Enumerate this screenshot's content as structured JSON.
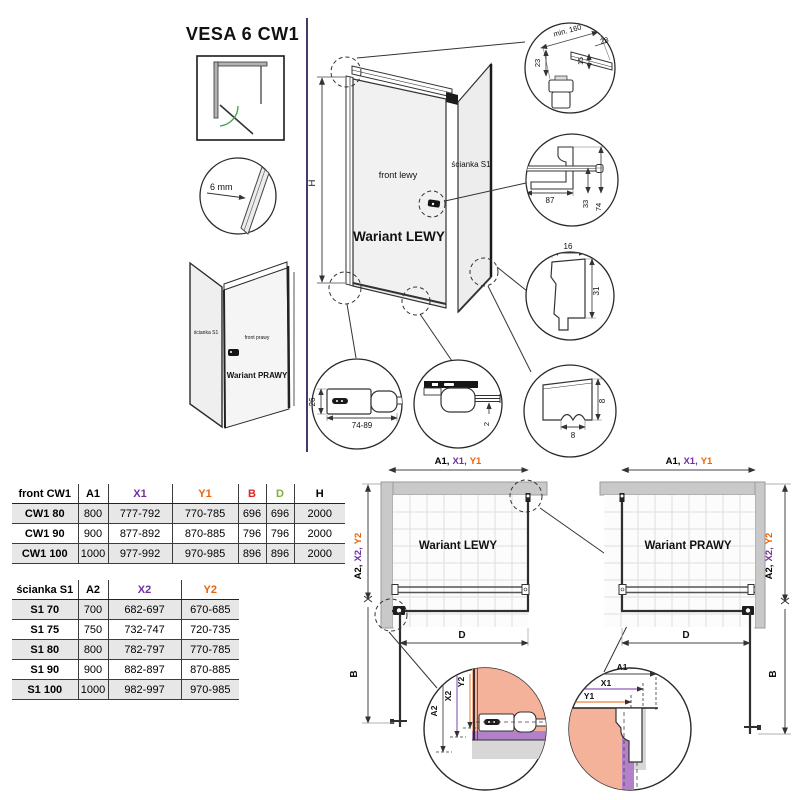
{
  "title": "VESA 6 CW1",
  "colors": {
    "purple": "#7030a0",
    "orange": "#e8650a",
    "red": "#e02424",
    "green": "#7fae3a",
    "salmon": "#f5b29b",
    "violet": "#b381c9",
    "wall_gray": "#c9c9c9",
    "line": "#333333"
  },
  "left_icons": {
    "glass_thickness": "6 mm"
  },
  "small_view": {
    "side_label": "ścianka S1",
    "front_label": "front prawy",
    "variant": "Wariant PRAWY"
  },
  "main_view": {
    "side_label": "ścianka S1",
    "front_label": "front lewy",
    "variant": "Wariant LEWY",
    "height": "H"
  },
  "details": {
    "corner": {
      "min_offset": "min. 160",
      "width": "28",
      "depth": "15",
      "height": "23"
    },
    "bracket": {
      "length": "87",
      "offset": "33",
      "total": "74"
    },
    "profile": {
      "width": "16",
      "depth": "31"
    },
    "handle": {
      "height": "26",
      "range": "74-89"
    },
    "door_bottom": {
      "gap": "2"
    },
    "seal": {
      "height": "8",
      "width": "8"
    }
  },
  "plans": {
    "left_variant": "Wariant LEWY",
    "right_variant": "Wariant PRAWY",
    "top_dim": {
      "a1": "A1,",
      "x1": "X1,",
      "y1": "Y1"
    },
    "side_dim": {
      "a2": "A2,",
      "x2": "X2,",
      "y2": "Y2"
    },
    "width_dim": "D",
    "door_dim": "B"
  },
  "zoom_details": {
    "left": {
      "a2": "A2",
      "x2": "X2",
      "y2": "Y2"
    },
    "right": {
      "a1": "A1",
      "x1": "X1",
      "y1": "Y1"
    }
  },
  "tables": {
    "front": {
      "header": [
        {
          "label": "front CW1",
          "color": "#000000"
        },
        {
          "label": "A1",
          "color": "#000000"
        },
        {
          "label": "X1",
          "color": "#7030a0"
        },
        {
          "label": "Y1",
          "color": "#e8650a"
        },
        {
          "label": "B",
          "color": "#e02424"
        },
        {
          "label": "D",
          "color": "#7fae3a"
        },
        {
          "label": "H",
          "color": "#000000"
        }
      ],
      "rows": [
        {
          "label": "CW1 80",
          "cells": [
            "800",
            "777-792",
            "770-785",
            "696",
            "696",
            "2000"
          ]
        },
        {
          "label": "CW1 90",
          "cells": [
            "900",
            "877-892",
            "870-885",
            "796",
            "796",
            "2000"
          ]
        },
        {
          "label": "CW1 100",
          "cells": [
            "1000",
            "977-992",
            "970-985",
            "896",
            "896",
            "2000"
          ]
        }
      ]
    },
    "side": {
      "header": [
        {
          "label": "ścianka S1",
          "color": "#000000"
        },
        {
          "label": "A2",
          "color": "#000000"
        },
        {
          "label": "X2",
          "color": "#7030a0"
        },
        {
          "label": "Y2",
          "color": "#e8650a"
        }
      ],
      "rows": [
        {
          "label": "S1 70",
          "cells": [
            "700",
            "682-697",
            "670-685"
          ]
        },
        {
          "label": "S1 75",
          "cells": [
            "750",
            "732-747",
            "720-735"
          ]
        },
        {
          "label": "S1 80",
          "cells": [
            "800",
            "782-797",
            "770-785"
          ]
        },
        {
          "label": "S1 90",
          "cells": [
            "900",
            "882-897",
            "870-885"
          ]
        },
        {
          "label": "S1 100",
          "cells": [
            "1000",
            "982-997",
            "970-985"
          ]
        }
      ]
    }
  }
}
